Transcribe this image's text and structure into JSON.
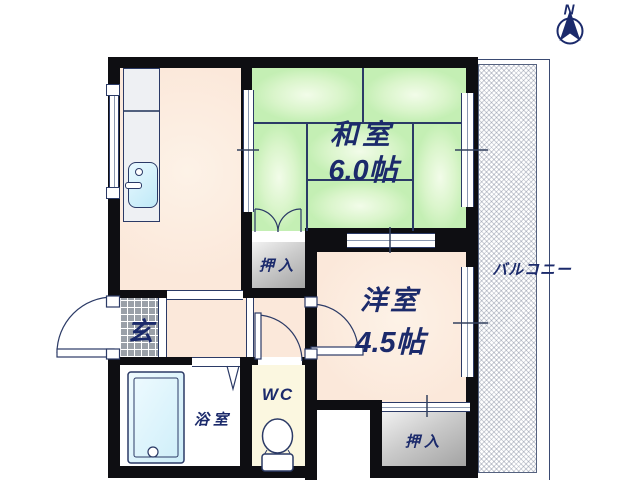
{
  "compass": {
    "north_label": "N"
  },
  "rooms": {
    "washitsu": {
      "name": "和室",
      "size": "6.0帖"
    },
    "youshitsu": {
      "name": "洋室",
      "size": "4.5帖"
    },
    "genkan": {
      "name": "玄"
    },
    "bathroom": {
      "name": "浴室"
    },
    "toilet": {
      "name": "WC"
    },
    "closet_washitsu": {
      "name": "押入"
    },
    "closet_youshitsu": {
      "name": "押入"
    },
    "balcony": {
      "name": "バルコニー"
    }
  },
  "colors": {
    "wall": "#0e0e12",
    "tatami_green": "#daf5cb",
    "floor_peach": "#fbe8da",
    "wc_floor_cream": "#fbf7e0",
    "closet_gray": "#cbcbcb",
    "water_blue": "#cdeef9",
    "label_navy": "#1b2a6b"
  }
}
